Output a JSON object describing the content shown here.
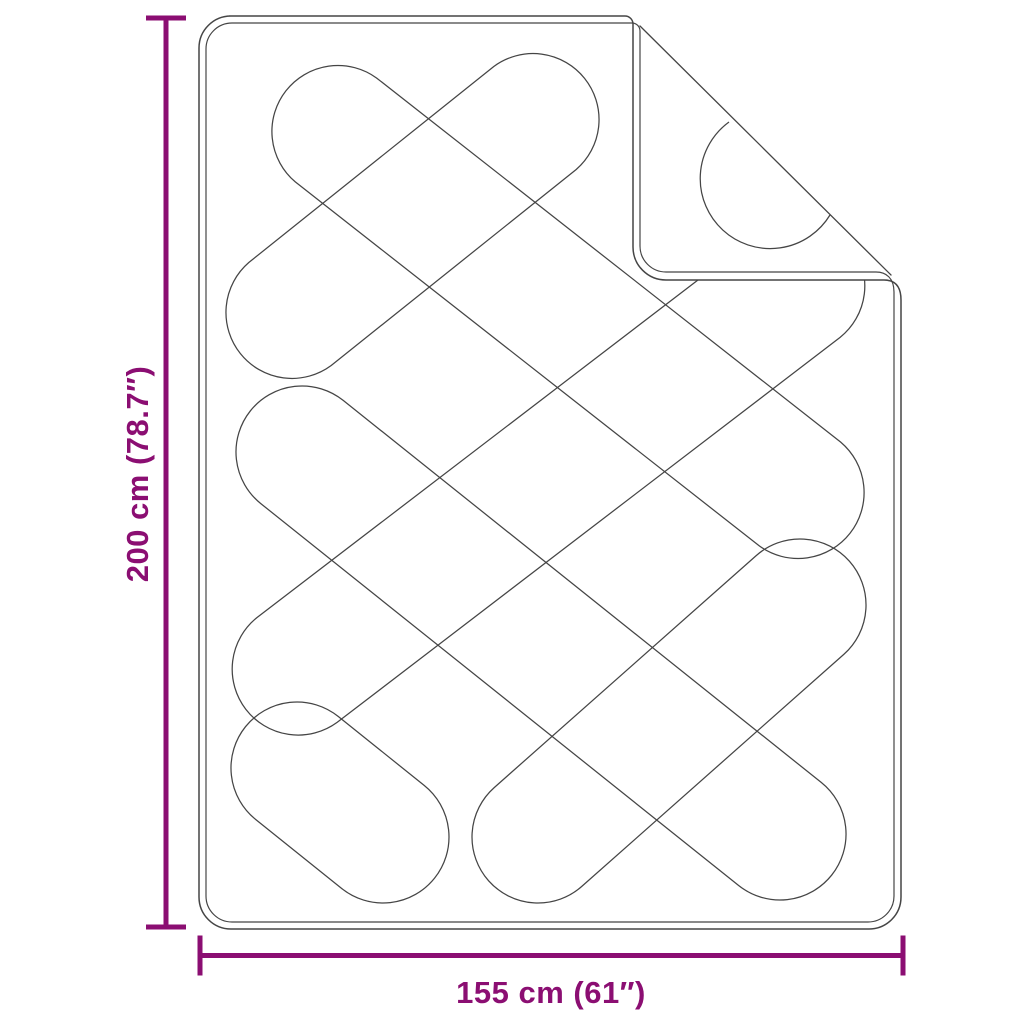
{
  "product": {
    "name": "quilted-blanket-dimension-diagram"
  },
  "dimensions": {
    "height": {
      "label": "200 cm (78.7″)",
      "cm": 200,
      "inches": 78.7
    },
    "width": {
      "label": "155 cm (61″)",
      "cm": 155,
      "inches": 61
    }
  },
  "colors": {
    "dimension_accent": "#8B0E72",
    "line": "#454545",
    "background": "#FFFFFF"
  },
  "blanket": {
    "outer_path": "M 229 16 L 625 16 A 8 8 0 0 1 633 24 L 633 247 A 33 33 0 0 0 666 280 L 884 280 C 895 280 901 286 901 300 L 901 897 A 32 32 0 0 1 869 929 L 231 929 A 32 32 0 0 1 199 897 L 199 48 A 32 32 0 0 1 231 16 Z",
    "inner_path": "M 236 23 L 632 23 A 8 8 0 0 1 640 31 L 640 246 A 26 26 0 0 0 666 272 L 876 272 C 886 272 894 278 894 292 L 894 896 A 26 26 0 0 1 868 922 L 232 922 A 26 26 0 0 1 206 896 L 206 49 A 26 26 0 0 1 232 23 Z",
    "crease_path": "M 640 26 L 891 275",
    "flap_fill_path": "M 633 24 L 633 247 A 33 33 0 0 0 666 280 L 893 280 L 894 277 L 641 24 Z",
    "flap_arc_path": "M 729 122 A 70 70 0 1 0 830 215",
    "quilt_cap_radius": 66,
    "quilt_capsules": [
      {
        "x1": 336,
        "y1": 130,
        "x2": 800,
        "y2": 494
      },
      {
        "x1": 302,
        "y1": 452,
        "x2": 780,
        "y2": 834
      },
      {
        "x1": 297,
        "y1": 768,
        "x2": 383,
        "y2": 837
      },
      {
        "x1": 535,
        "y1": 118,
        "x2": 290,
        "y2": 314
      },
      {
        "x1": 800,
        "y1": 285,
        "x2": 297,
        "y2": 670
      },
      {
        "x1": 800,
        "y1": 605,
        "x2": 538,
        "y2": 837
      }
    ]
  },
  "height_dim": {
    "x": 166,
    "y1": 18,
    "y2": 927,
    "cap_x1": 146,
    "cap_x2": 186,
    "label_x": 148,
    "label_y": 474
  },
  "width_dim": {
    "y": 955.5,
    "x1": 200,
    "x2": 903,
    "cap_y1": 935.5,
    "cap_y2": 975.5,
    "label_x": 551,
    "label_y": 1003
  }
}
